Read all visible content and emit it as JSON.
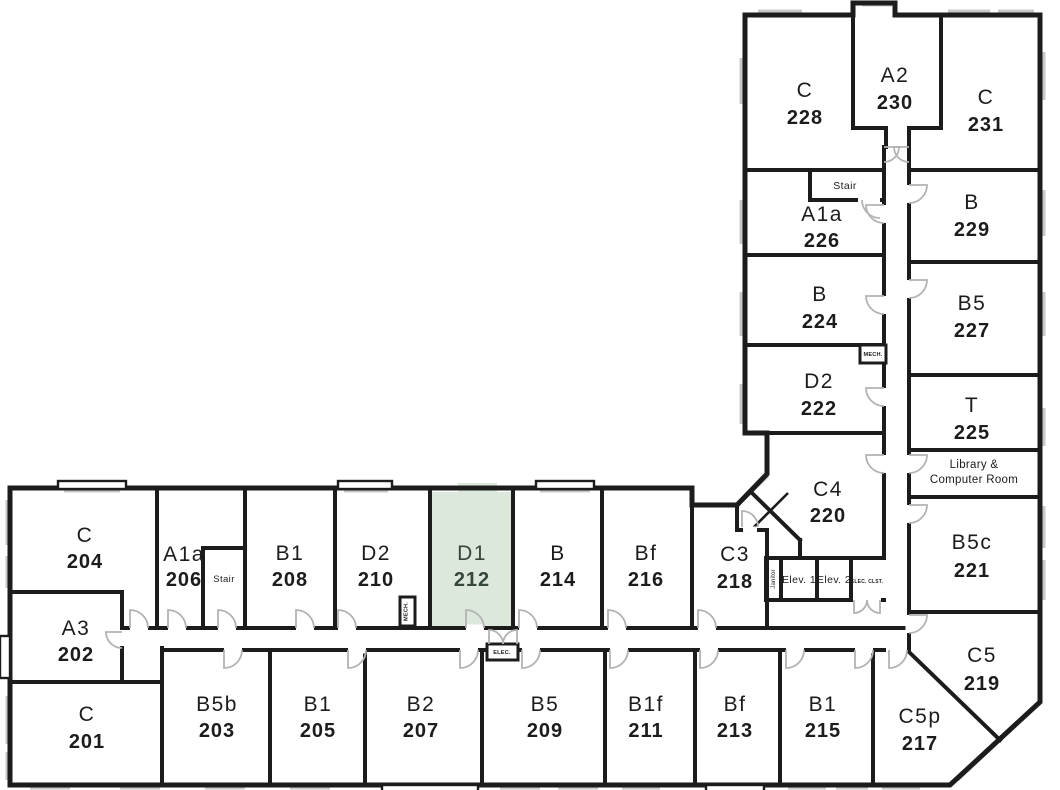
{
  "plan": {
    "highlight_color": "#dce8dc",
    "wall_color": "#1c1c1c",
    "rooms": {
      "228": {
        "type": "C",
        "number": "228"
      },
      "230": {
        "type": "A2",
        "number": "230"
      },
      "231": {
        "type": "C",
        "number": "231"
      },
      "226": {
        "type": "A1a",
        "number": "226"
      },
      "229": {
        "type": "B",
        "number": "229"
      },
      "224": {
        "type": "B",
        "number": "224"
      },
      "227": {
        "type": "B5",
        "number": "227"
      },
      "222": {
        "type": "D2",
        "number": "222"
      },
      "225": {
        "type": "T",
        "number": "225"
      },
      "220": {
        "type": "C4",
        "number": "220"
      },
      "221": {
        "type": "B5c",
        "number": "221"
      },
      "219": {
        "type": "C5",
        "number": "219"
      },
      "217": {
        "type": "C5p",
        "number": "217"
      },
      "204": {
        "type": "C",
        "number": "204"
      },
      "206": {
        "type": "A1a",
        "number": "206"
      },
      "208": {
        "type": "B1",
        "number": "208"
      },
      "210": {
        "type": "D2",
        "number": "210"
      },
      "212": {
        "type": "D1",
        "number": "212",
        "highlighted": true
      },
      "214": {
        "type": "B",
        "number": "214"
      },
      "216": {
        "type": "Bf",
        "number": "216"
      },
      "218": {
        "type": "C3",
        "number": "218"
      },
      "202": {
        "type": "A3",
        "number": "202"
      },
      "201": {
        "type": "C",
        "number": "201"
      },
      "203": {
        "type": "B5b",
        "number": "203"
      },
      "205": {
        "type": "B1",
        "number": "205"
      },
      "207": {
        "type": "B2",
        "number": "207"
      },
      "209": {
        "type": "B5",
        "number": "209"
      },
      "211": {
        "type": "B1f",
        "number": "211"
      },
      "213": {
        "type": "Bf",
        "number": "213"
      },
      "215": {
        "type": "B1",
        "number": "215"
      }
    },
    "labels": {
      "stair_upper": "Stair",
      "stair_lower": "Stair",
      "mech_upper": "MECH.",
      "mech_lower": "MECH.",
      "elev1": "Elev. 1",
      "elev2": "Elev. 2",
      "elec_clst": "ELEC. CLST.",
      "elec": "ELEC.",
      "janitor": "Janitor",
      "library_line1": "Library &",
      "library_line2": "Computer Room"
    }
  }
}
